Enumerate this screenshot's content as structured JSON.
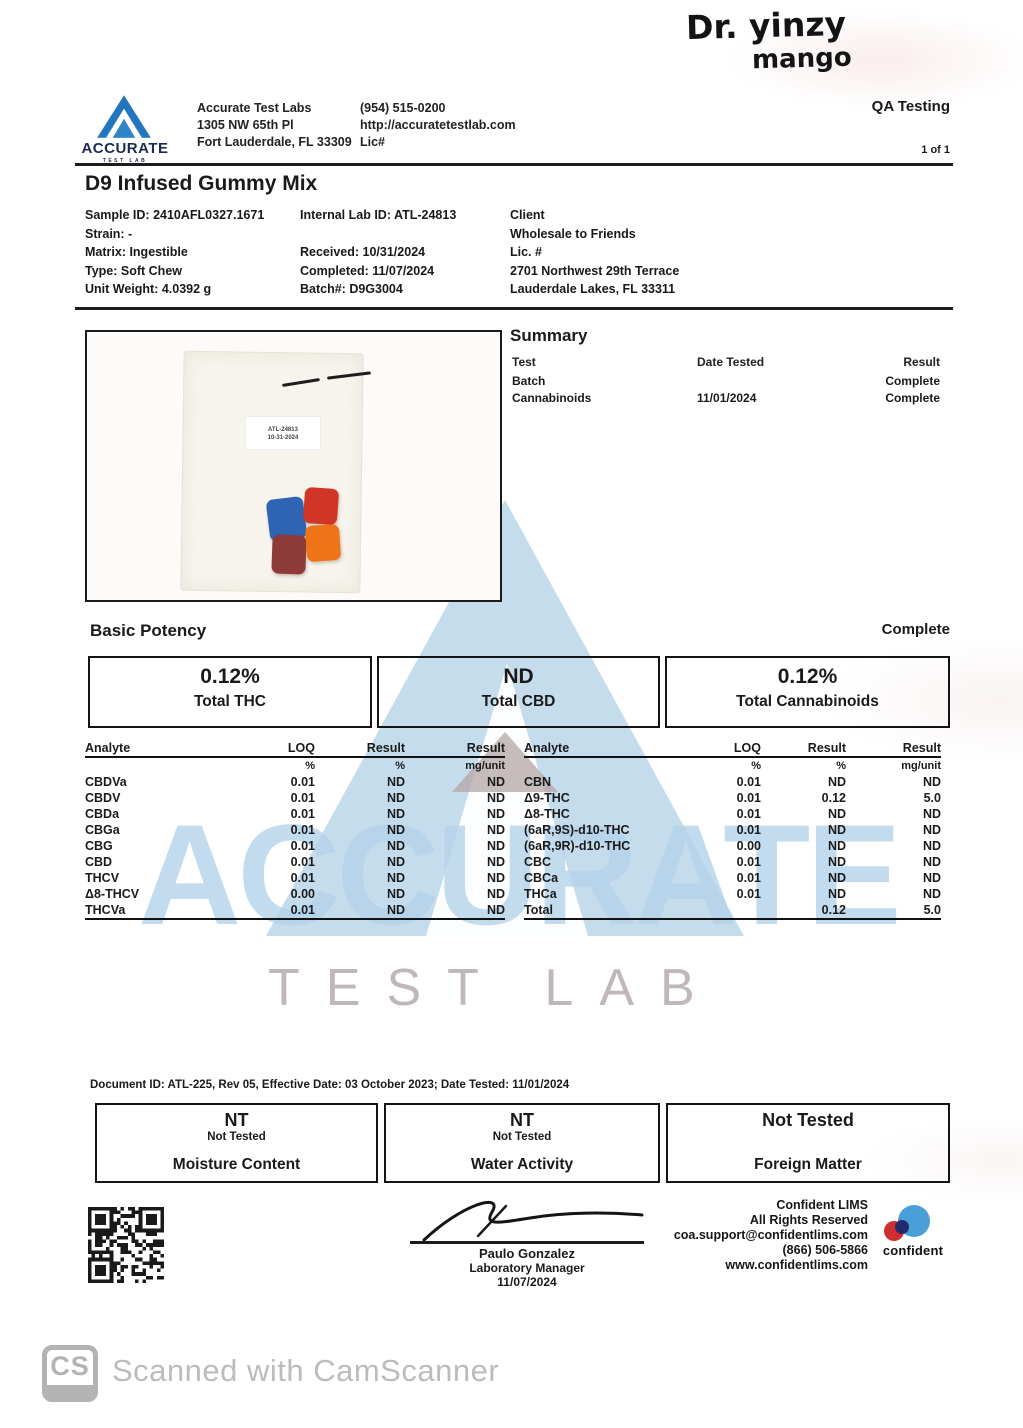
{
  "handwriting": {
    "line1": "Dr. yinzy",
    "line2": "mango"
  },
  "header": {
    "logo_text": "ACCURATE",
    "logo_subtext": "TEST LAB",
    "lab_lines": [
      "Accurate Test Labs",
      "1305 NW 65th Pl",
      "Fort Lauderdale, FL 33309"
    ],
    "contact_lines": [
      "(954) 515-0200",
      "http://accuratetestlab.com",
      "Lic#"
    ],
    "qa_label": "QA Testing",
    "page_count": "1 of 1"
  },
  "title": "D9 Infused Gummy Mix",
  "sample_info": {
    "col1": [
      "Sample ID: 2410AFL0327.1671",
      "Strain: -",
      "Matrix: Ingestible",
      "Type: Soft Chew",
      "Unit Weight: 4.0392 g"
    ],
    "col2": [
      "Internal Lab ID: ATL-24813",
      "",
      "Received: 10/31/2024",
      "Completed: 11/07/2024",
      "Batch#:  D9G3004"
    ],
    "col3": [
      "Client",
      "Wholesale to Friends",
      "Lic. #",
      "2701 Northwest 29th Terrace",
      "Lauderdale Lakes, FL 33311"
    ]
  },
  "photo": {
    "label_line1": "ATL-24813",
    "label_line2": "10-31-2024",
    "gummies": [
      {
        "name": "blue-gummy",
        "color": "#2f64b5"
      },
      {
        "name": "red-gummy",
        "color": "#d03527"
      },
      {
        "name": "maroon-gummy",
        "color": "#8e3a38"
      },
      {
        "name": "orange-gummy",
        "color": "#ef7417"
      }
    ]
  },
  "summary": {
    "heading": "Summary",
    "columns": [
      "Test",
      "Date Tested",
      "Result"
    ],
    "rows": [
      {
        "test": "Batch",
        "date": "",
        "result": "Complete"
      },
      {
        "test": "Cannabinoids",
        "date": "11/01/2024",
        "result": "Complete"
      }
    ]
  },
  "potency": {
    "heading": "Basic Potency",
    "status": "Complete",
    "boxes": [
      {
        "value": "0.12%",
        "label": "Total THC"
      },
      {
        "value": "ND",
        "label": "Total CBD"
      },
      {
        "value": "0.12%",
        "label": "Total Cannabinoids"
      }
    ]
  },
  "analyte_table": {
    "columns": [
      "Analyte",
      "LOQ",
      "Result",
      "Result"
    ],
    "units": [
      "",
      "%",
      "%",
      "mg/unit"
    ],
    "left_rows": [
      {
        "analyte": "CBDVa",
        "loq": "0.01",
        "pct": "ND",
        "mg": "ND"
      },
      {
        "analyte": "CBDV",
        "loq": "0.01",
        "pct": "ND",
        "mg": "ND"
      },
      {
        "analyte": "CBDa",
        "loq": "0.01",
        "pct": "ND",
        "mg": "ND"
      },
      {
        "analyte": "CBGa",
        "loq": "0.01",
        "pct": "ND",
        "mg": "ND"
      },
      {
        "analyte": "CBG",
        "loq": "0.01",
        "pct": "ND",
        "mg": "ND"
      },
      {
        "analyte": "CBD",
        "loq": "0.01",
        "pct": "ND",
        "mg": "ND"
      },
      {
        "analyte": "THCV",
        "loq": "0.01",
        "pct": "ND",
        "mg": "ND"
      },
      {
        "analyte": "Δ8-THCV",
        "loq": "0.00",
        "pct": "ND",
        "mg": "ND"
      },
      {
        "analyte": "THCVa",
        "loq": "0.01",
        "pct": "ND",
        "mg": "ND"
      }
    ],
    "right_rows": [
      {
        "analyte": "CBN",
        "loq": "0.01",
        "pct": "ND",
        "mg": "ND"
      },
      {
        "analyte": "Δ9-THC",
        "loq": "0.01",
        "pct": "0.12",
        "mg": "5.0"
      },
      {
        "analyte": "Δ8-THC",
        "loq": "0.01",
        "pct": "ND",
        "mg": "ND"
      },
      {
        "analyte": "(6aR,9S)-d10-THC",
        "loq": "0.01",
        "pct": "ND",
        "mg": "ND"
      },
      {
        "analyte": "(6aR,9R)-d10-THC",
        "loq": "0.00",
        "pct": "ND",
        "mg": "ND"
      },
      {
        "analyte": "CBC",
        "loq": "0.01",
        "pct": "ND",
        "mg": "ND"
      },
      {
        "analyte": "CBCa",
        "loq": "0.01",
        "pct": "ND",
        "mg": "ND"
      },
      {
        "analyte": "THCa",
        "loq": "0.01",
        "pct": "ND",
        "mg": "ND"
      },
      {
        "analyte": "Total",
        "loq": "",
        "pct": "0.12",
        "mg": "5.0"
      }
    ]
  },
  "watermark": {
    "big_text": "ACCURATE",
    "sub_text": "TEST LAB"
  },
  "document_line": "Document ID: ATL-225, Rev 05, Effective Date: 03 October 2023; Date Tested: 11/01/2024",
  "not_tested_boxes": [
    {
      "value": "NT",
      "note": "Not Tested",
      "label": "Moisture Content"
    },
    {
      "value": "NT",
      "note": "Not Tested",
      "label": "Water Activity"
    },
    {
      "value": "Not Tested",
      "note": "",
      "label": "Foreign Matter"
    }
  ],
  "signature": {
    "name": "Paulo Gonzalez",
    "title": "Laboratory Manager",
    "date": "11/07/2024"
  },
  "lims": {
    "lines": [
      "Confident LIMS",
      "All Rights Reserved",
      "coa.support@confidentlims.com",
      "(866) 506-5866",
      "www.confidentlims.com"
    ],
    "logo_text": "confident"
  },
  "camscanner": {
    "icon_text": "CS",
    "text": "Scanned with CamScanner"
  },
  "colors": {
    "logo_blue": "#2176be",
    "logo_navy": "#1c2c50",
    "watermark_blue": "#b5d3ea",
    "watermark_mauve": "#b4a6a6",
    "confident_blue": "#4a9fd8",
    "confident_red": "#cf2e2e",
    "confident_navy": "#252a6e",
    "camscanner_gray": "#b3b3b3"
  }
}
